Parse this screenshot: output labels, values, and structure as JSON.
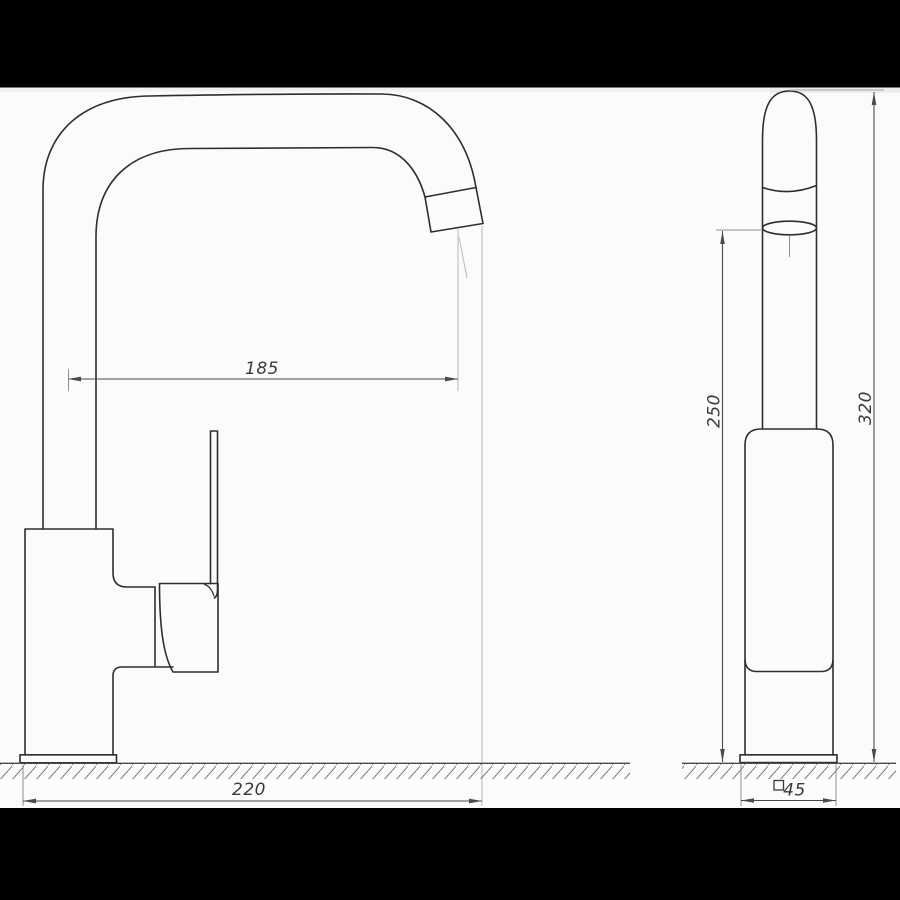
{
  "theme": {
    "bg": "#fbfbfb",
    "bar": "#000000",
    "line": "#2e2e2e",
    "dim": "#4a4a4a",
    "ext": "#8f8f8f",
    "faint": "#bdbdbd",
    "text": "#3a3a3a",
    "hatch": "#6f6f6f"
  },
  "dimensions": {
    "spout_reach": "185",
    "overall_length": "220",
    "spout_height": "250",
    "overall_height": "320",
    "base_square": "45",
    "base_square_symbol": "square-outline"
  }
}
